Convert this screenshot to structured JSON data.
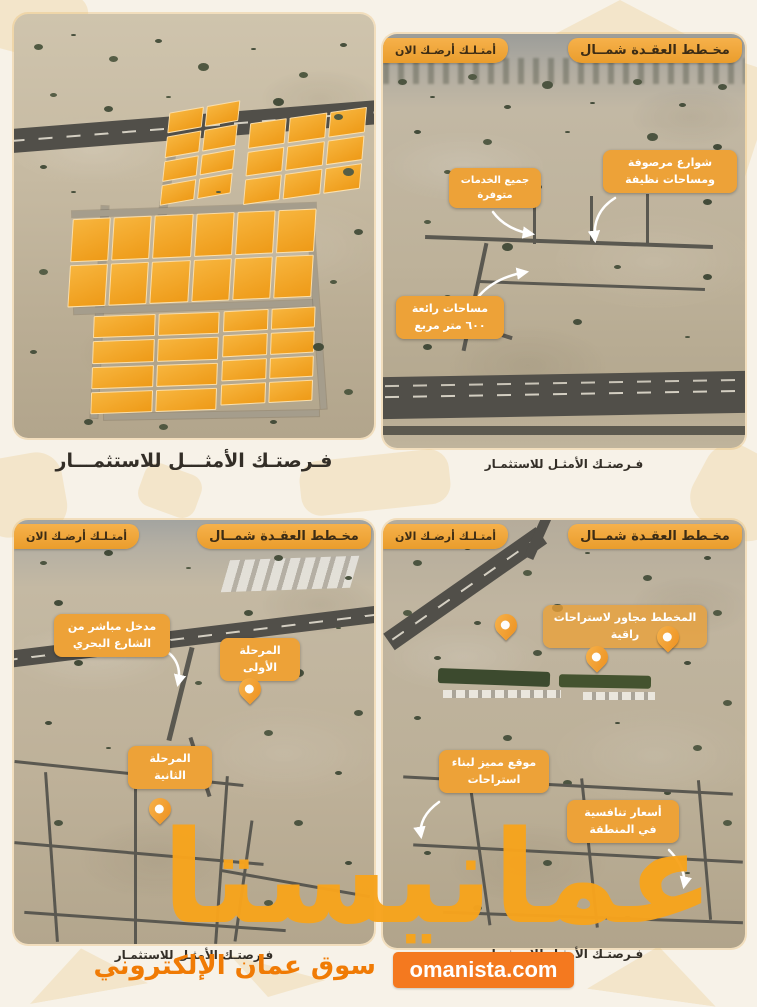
{
  "poster": {
    "watermark": "عمانيستا",
    "tagline": "سوق عمان الإلكتروني",
    "website": "omanista.com",
    "accent_orange": "#f7a41d",
    "button_orange": "#f4791f",
    "tag_orange": "#f0a83c"
  },
  "panels": [
    {
      "name": "plots-aerial-overview",
      "caption": "فـرصتـك الأمثـــل للاستثمـــار"
    },
    {
      "name": "plan-streets-view",
      "tag_title": "مخـطط العقـدة شمــال",
      "tag_cta": "أمتـلـك أرضـك الان",
      "caption": "فـرصتـك الأمثـل للاستثمـار",
      "annotations": [
        {
          "label": "شوارع مرصوفة ومساحات نظيفة"
        },
        {
          "label": "جميع الخدمات متوفرة"
        },
        {
          "label": "مساحات رائعة ٦٠٠ متر مربع"
        }
      ]
    },
    {
      "name": "phases-view",
      "tag_title": "مخـطط العقـدة شمــال",
      "tag_cta": "أمتـلـك أرضـك الان",
      "caption": "فـرصتـك الأمثـل للاستثمـار",
      "annotations": [
        {
          "label": "مدخل مباشر من الشارع البحري"
        },
        {
          "label": "المرحلة الأولى"
        },
        {
          "label": "المرحلة الثانية"
        }
      ]
    },
    {
      "name": "surroundings-view",
      "tag_title": "مخـطط العقـدة شمــال",
      "tag_cta": "أمتـلـك أرضـك الان",
      "caption": "فـرصتـك الأمثـل للاستثمـار",
      "annotations": [
        {
          "label": "المخطط مجاور لاستراحات راقية"
        },
        {
          "label": "موقع مميز لبناء استراحات"
        },
        {
          "label": "أسعار تنافسية في المنطقة"
        }
      ]
    }
  ]
}
